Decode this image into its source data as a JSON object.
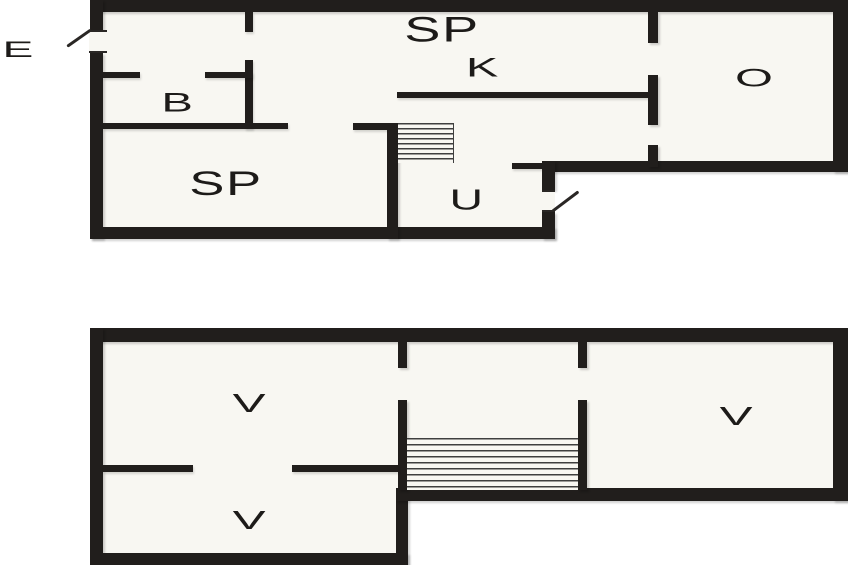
{
  "colors": {
    "wall": "#211e1c",
    "room_fill": "#f8f7f2",
    "background": "#ffffff",
    "stair_tread": "#3f3f3f",
    "label_text": "#1d1b19"
  },
  "floors": [
    {
      "name": "upper-floor",
      "labels": [
        {
          "text": "E"
        },
        {
          "text": "B"
        },
        {
          "text": "SP"
        },
        {
          "text": "K"
        },
        {
          "text": "O"
        },
        {
          "text": "SP"
        },
        {
          "text": "U"
        }
      ]
    },
    {
      "name": "lower-floor",
      "labels": [
        {
          "text": "V"
        },
        {
          "text": "V"
        },
        {
          "text": "V"
        }
      ]
    }
  ]
}
